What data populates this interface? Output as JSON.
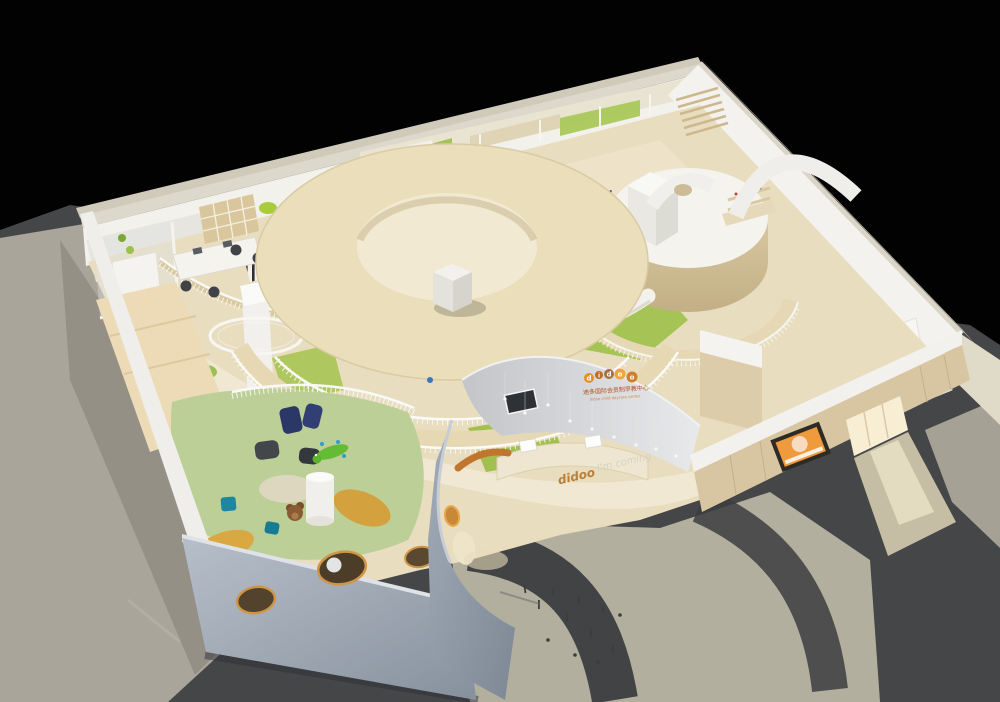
{
  "scene": {
    "type": "3D architectural rendering",
    "subject": "Isometric cutaway model of a children's daycare center interior on a black background",
    "background": "#000000"
  },
  "branding": {
    "logo": "didoo",
    "logo_letters": [
      "d",
      "i",
      "d",
      "o",
      "o"
    ],
    "tagline_cn": "迪多国际会员制早教中心",
    "tagline_en": "didoo child daycare center",
    "floor_logo": "didoo",
    "floor_tagline": "I'm coming",
    "logo_orange": "#e8923a",
    "text_orange": "#b54f1e"
  },
  "palette": {
    "roof_cream": "#eadebb",
    "wall_white": "#f3f2ee",
    "wood_floor": "#e8dcc2",
    "wood_wall": "#d8c6a2",
    "play_green": "#bccf97",
    "grass_green": "#a6c455",
    "front_wall_gray": "#9aa4b0",
    "ground_light": "#a9a59b",
    "ground_dark": "#46474a",
    "shadow": "#3a3b3d",
    "door_yellow": "#f2a612",
    "poster_orange": "#ef9a3c",
    "porthole_rim": "#cf9446",
    "ball_yellow": "#e8c838",
    "beanbag_navy": "#2b3766",
    "beanbag_teal": "#1d87a0",
    "beanbag_mustard": "#d9a843"
  }
}
